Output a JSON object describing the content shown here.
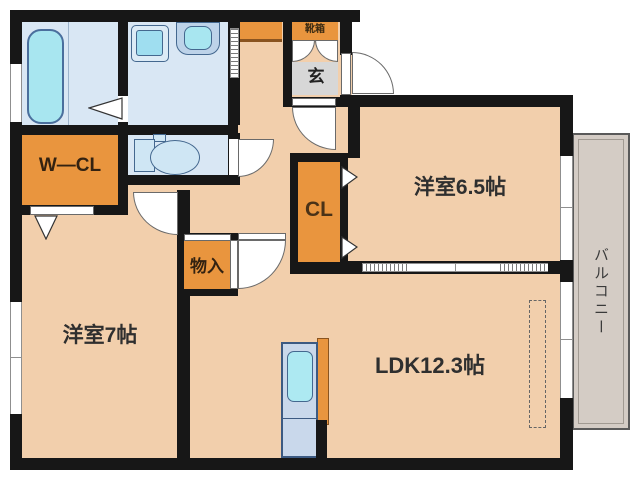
{
  "title": "apartment floor plan",
  "labels": {
    "bedroom_65": "洋室6.5帖",
    "bedroom_7": "洋室7帖",
    "ldk": "LDK12.3帖",
    "walk_in_closet": "W—CL",
    "closet": "CL",
    "storage": "物入",
    "entrance": "玄",
    "shoe_box": "靴箱",
    "balcony": "バルコニー"
  },
  "colors": {
    "wall": "#171717",
    "room_floor": "#f2cfac",
    "closet_fill": "#e9953e",
    "wet_area_floor": "#d9e7f4",
    "fixture_aqua": "#a8e6f0",
    "entrance_floor": "#d7d7d7",
    "balcony_floor": "#d4ccc5",
    "kitchen_counter": "#c9d8eb"
  }
}
